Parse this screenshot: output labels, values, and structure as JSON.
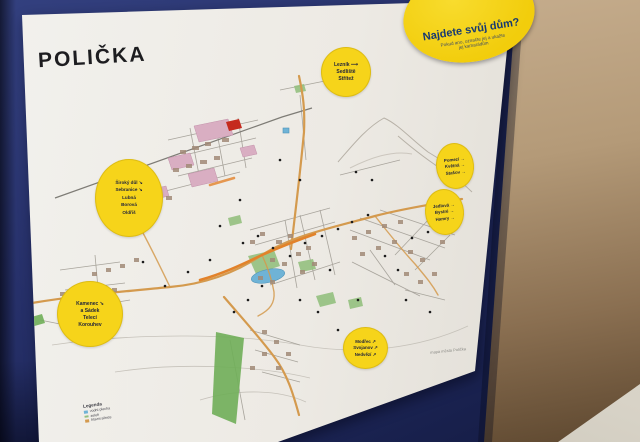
{
  "poster": {
    "title": "POLIČKA",
    "legend": {
      "title": "Legenda",
      "items": [
        {
          "label": "vodní plocha"
        },
        {
          "label": "zeleň"
        },
        {
          "label": "hlavní silnice"
        }
      ]
    },
    "credits": "mapa města Polička"
  },
  "badge": {
    "title": "Najdete svůj dům?",
    "line1": "Pokud ano, označte jej a ukažte",
    "line2": "jej kamarádům"
  },
  "circles": [
    {
      "id": "north",
      "lines": [
        "Lezník ⟶",
        "Sedliště",
        "Střítež"
      ]
    },
    {
      "id": "west",
      "lines": [
        "Široký důl ↘",
        "Sebranice ↘",
        "Lubná",
        "Borová",
        "Oldřiš"
      ]
    },
    {
      "id": "southwest",
      "lines": [
        "Kamenec ➘",
        "a Sádek",
        "Telecí",
        "Korouhev"
      ]
    },
    {
      "id": "east-upper",
      "lines": [
        "Pomezí →",
        "Květná →",
        "Stašov →"
      ]
    },
    {
      "id": "east-lower",
      "lines": [
        "Jedlová →",
        "Bystré →",
        "Hamry →"
      ]
    },
    {
      "id": "south",
      "lines": [
        "Modřec ↗",
        "Svojanov ↗",
        "Nedvězí ↗"
      ]
    }
  ],
  "colors": {
    "board": "#27316b",
    "wall": "#b49a78",
    "table": "#d8d3c7",
    "poster": "#edeae4",
    "badge_yellow": "#f2cd0c",
    "circle_yellow": "#f6d41a",
    "map_road": "#d49a4e",
    "map_orange": "#e2822a",
    "map_green": "#93c07e",
    "map_water": "#6fb3d6",
    "map_pink": "#d9aec2",
    "map_red": "#c52a1e"
  }
}
